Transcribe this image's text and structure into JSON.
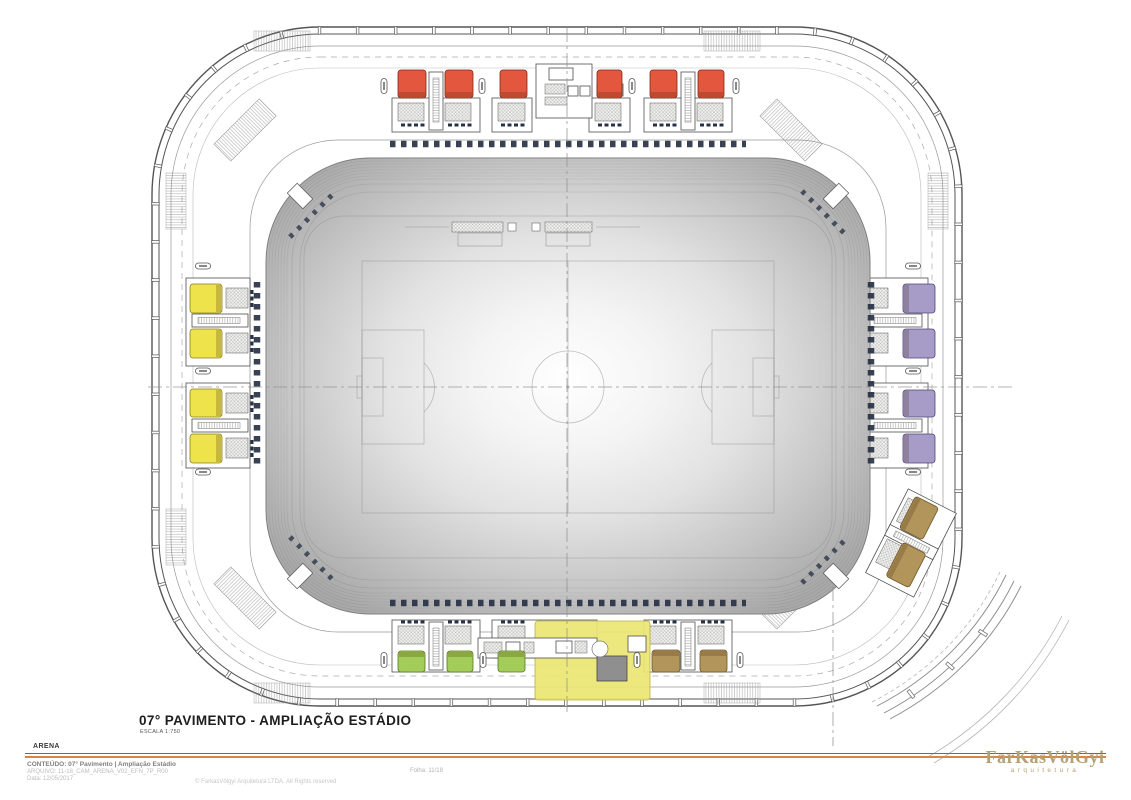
{
  "sheet": {
    "title": "07° PAVIMENTO - AMPLIAÇÃO ESTÁDIO",
    "scale": "ESCALA 1:750"
  },
  "title_block": {
    "project": "ARENA",
    "content": "CONTEÚDO: 07° Pavimento | Ampliação Estádio",
    "file": "ARQUIVO: 11-18_CAM_ARENA_V02_EFN_7P_R00",
    "date": "Data: 12/05/2017",
    "sheet_number": "Folha: 11/18",
    "copyright": "© FarkasVölgyi Arquitetura LTDA. All Rights reserved",
    "logo_name": "FarKasVölGyi",
    "logo_subtitle": "arquitetura"
  },
  "palette": {
    "accent_orange": "#dd8442",
    "logo_tan": "#b5a171",
    "navy_marks": "#273244",
    "zone_red": "#e2573d",
    "zone_yellow": "#eee34b",
    "zone_purple": "#a79bc7",
    "zone_green": "#a3cc58",
    "zone_tan": "#b2955a",
    "zone_service_yellow": "#ebe672"
  },
  "plan": {
    "zones": [
      {
        "id": "service-area-south",
        "color": "#ebe672",
        "stroke": "#b9b242",
        "layer": "under",
        "strip": "",
        "boxes": [
          [
            535,
            621,
            115,
            79,
            0
          ]
        ]
      },
      {
        "id": "north-boxes-red",
        "color": "#e2573d",
        "stroke": "#7a2a1a",
        "layer": "over",
        "strip": "s",
        "boxes": [
          [
            398,
            70,
            28,
            28,
            0
          ],
          [
            445,
            70,
            28,
            28,
            0
          ],
          [
            500,
            70,
            27,
            28,
            0
          ],
          [
            597,
            70,
            25,
            28,
            0
          ],
          [
            650,
            70,
            27,
            28,
            0
          ],
          [
            698,
            70,
            26,
            28,
            0
          ]
        ]
      },
      {
        "id": "west-boxes-yellow",
        "color": "#eee34b",
        "stroke": "#8a7f1e",
        "layer": "over",
        "strip": "e",
        "boxes": [
          [
            190,
            284,
            32,
            29,
            0
          ],
          [
            190,
            329,
            32,
            29,
            0
          ],
          [
            190,
            389,
            32,
            28,
            0
          ],
          [
            190,
            434,
            32,
            29,
            0
          ]
        ]
      },
      {
        "id": "east-boxes-purple",
        "color": "#a79bc7",
        "stroke": "#4f4478",
        "layer": "over",
        "strip": "w",
        "boxes": [
          [
            903,
            284,
            32,
            29,
            0
          ],
          [
            903,
            329,
            32,
            29,
            0
          ],
          [
            903,
            390,
            32,
            27,
            0
          ],
          [
            903,
            434,
            32,
            29,
            0
          ]
        ]
      },
      {
        "id": "south-boxes-green",
        "color": "#a3cc58",
        "stroke": "#55771f",
        "layer": "over",
        "strip": "n",
        "boxes": [
          [
            398,
            651,
            27,
            21,
            0
          ],
          [
            447,
            651,
            26,
            21,
            0
          ],
          [
            498,
            651,
            27,
            21,
            0
          ]
        ]
      },
      {
        "id": "south-boxes-tan",
        "color": "#b2955a",
        "stroke": "#6b5526",
        "layer": "over",
        "strip": "n",
        "boxes": [
          [
            652,
            650,
            28,
            22,
            0
          ],
          [
            700,
            650,
            27,
            22,
            0
          ]
        ]
      },
      {
        "id": "southeast-boxes-tan",
        "color": "#b2955a",
        "stroke": "#6b5526",
        "layer": "over",
        "strip": "w",
        "boxes": [
          [
            906,
            500,
            26,
            36,
            27
          ],
          [
            893,
            546,
            26,
            38,
            27
          ]
        ]
      }
    ]
  }
}
